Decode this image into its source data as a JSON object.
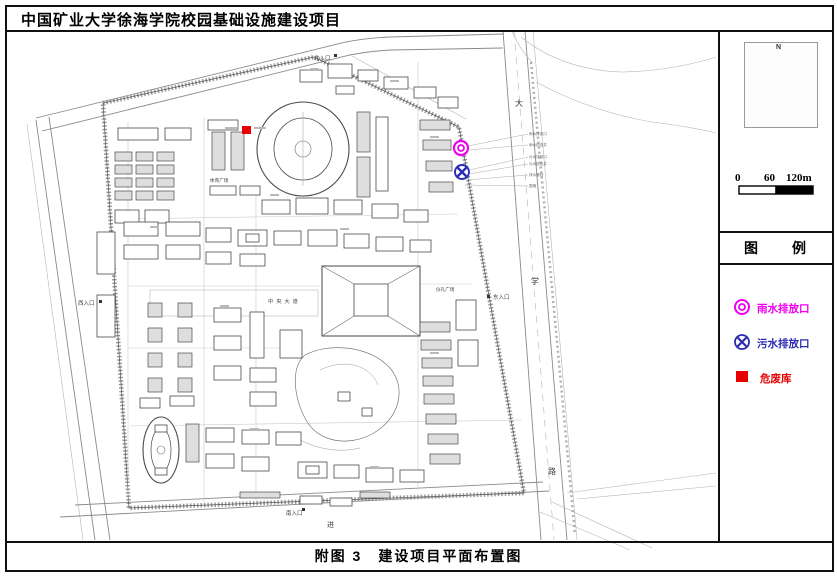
{
  "page": {
    "title": "中国矿业大学徐海学院校园基础设施建设项目",
    "caption": "附图 3　建设项目平面布置图"
  },
  "sidebar": {
    "compass_n": "N",
    "scale_ticks": [
      "0",
      "60",
      "120m"
    ],
    "legend_title": "图　例",
    "legend_items": [
      {
        "label": "雨水排放口",
        "symbol": "double-circle",
        "color": "#f000f0"
      },
      {
        "label": "污水排放口",
        "symbol": "circle-x",
        "color": "#2b2bb4"
      },
      {
        "label": "危废库",
        "symbol": "filled-square",
        "color": "#e60000"
      }
    ]
  },
  "map": {
    "entrance_north": "北入口",
    "entrance_west": "西入口",
    "entrance_east": "东入口",
    "entrance_south": "南入口",
    "road_char_1": "大",
    "road_char_2": "学",
    "road_char_3": "路",
    "bottom_road_char": "进",
    "label_central": "中央大道",
    "label_plaza": "仪礼广场",
    "label_sports": "体育广场",
    "annotations": [
      "雨水排放口",
      "雨水检查井",
      "污水排放口",
      "污水检查井",
      "排水管线",
      "围墙"
    ]
  },
  "colors": {
    "rain": "#f000f0",
    "sewage": "#2b2bb4",
    "hazard": "#e60000"
  }
}
